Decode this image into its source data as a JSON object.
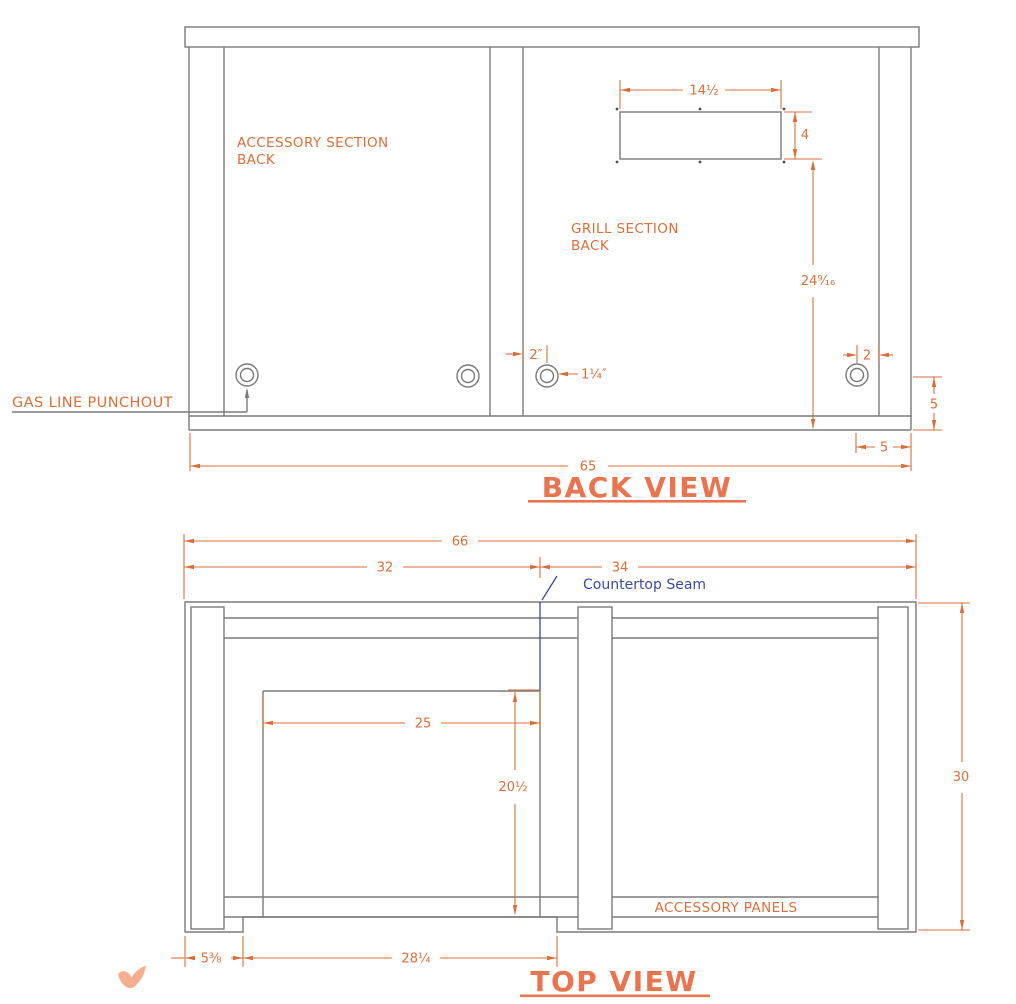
{
  "colors": {
    "line": "#7a7a7a",
    "dark": "#4f4f4f",
    "dim": "#d5703c",
    "title": "#e87450",
    "seam": "#3a49a2",
    "bird": "#f5ae8e",
    "bg": "#ffffff"
  },
  "back": {
    "title": "BACK VIEW",
    "labels": {
      "accessory": [
        "ACCESSORY SECTION",
        "BACK"
      ],
      "grill": [
        "GRILL SECTION",
        "BACK"
      ],
      "punchout": "GAS LINE PUNCHOUT"
    },
    "dims": {
      "cutout_width": "14½",
      "cutout_height": "4",
      "cutout_to_base": "24⁹⁄₁₆",
      "punchout_offset": "2″",
      "punchout_diameter": "1¼″",
      "punchout_edge_offset": "2",
      "base_height": "5",
      "panel_inset": "5",
      "overall_width": "65"
    }
  },
  "top": {
    "title": "TOP VIEW",
    "labels": {
      "seam": "Countertop Seam",
      "accessory_panels": "ACCESSORY PANELS"
    },
    "dims": {
      "overall_width": "66",
      "grill_section_width": "32",
      "accessory_section_width": "34",
      "cutout_width": "25",
      "cutout_depth": "20½",
      "overall_depth": "30",
      "left_offset": "5⅜",
      "front_opening": "28¼"
    }
  }
}
